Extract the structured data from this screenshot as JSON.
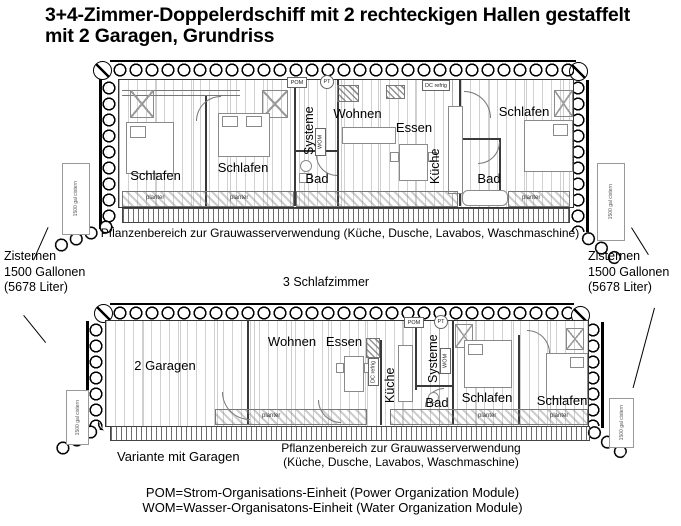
{
  "title": {
    "line1": "3+4-Zimmer-Doppelerdschiff mit 2 rechteckigen Hallen gestaffelt",
    "line2": "mit 2 Garagen, Grundriss"
  },
  "upper_plan": {
    "rooms": {
      "schlafen1": "Schlafen",
      "schlafen2": "Schlafen",
      "bad1": "Bad",
      "systeme": "Systeme",
      "wohnen": "Wohnen",
      "essen": "Essen",
      "kueche": "Küche",
      "bad2": "Bad",
      "schlafen3": "Schlafen"
    },
    "modules": {
      "pom": "POM",
      "pt": "PT",
      "wom": "WOM",
      "dc_refrig": "DC refrig"
    },
    "planter_label": "planter",
    "cistern_label": "1500 gal cistern",
    "greywater_note": "Pflanzenbereich zur Grauwasserverwendung (Küche, Dusche, Lavabos, Waschmaschine)"
  },
  "between": {
    "bedrooms_note": "3 Schlafzimmer"
  },
  "cistern_left": {
    "line1": "Zisternen",
    "line2": "1500 Gallonen",
    "line3": "(5678 Liter)"
  },
  "cistern_right": {
    "line1": "Zisternen",
    "line2": "1500 Gallonen",
    "line3": "(5678 Liter)"
  },
  "lower_plan": {
    "rooms": {
      "garagen": "2 Garagen",
      "wohnen": "Wohnen",
      "essen": "Essen",
      "kueche": "Küche",
      "systeme": "Systeme",
      "bad": "Bad",
      "schlafen1": "Schlafen",
      "schlafen2": "Schlafen"
    },
    "modules": {
      "pom": "POM",
      "pt": "PT",
      "wom": "WOM",
      "dc_refrig": "DC refrig"
    },
    "planter_label": "planter",
    "cistern_label": "1500 gal cistern",
    "variant_caption": "Variante mit Garagen",
    "greywater_note_line1": "Pflanzenbereich zur Grauwasserverwendung",
    "greywater_note_line2": "(Küche, Dusche, Lavabos, Waschmaschine)"
  },
  "legend": {
    "pom": "POM=Strom-Organisations-Einheit (Power Organization Module)",
    "wom": "WOM=Wasser-Organisatons-Einheit (Water Organization Module)"
  }
}
